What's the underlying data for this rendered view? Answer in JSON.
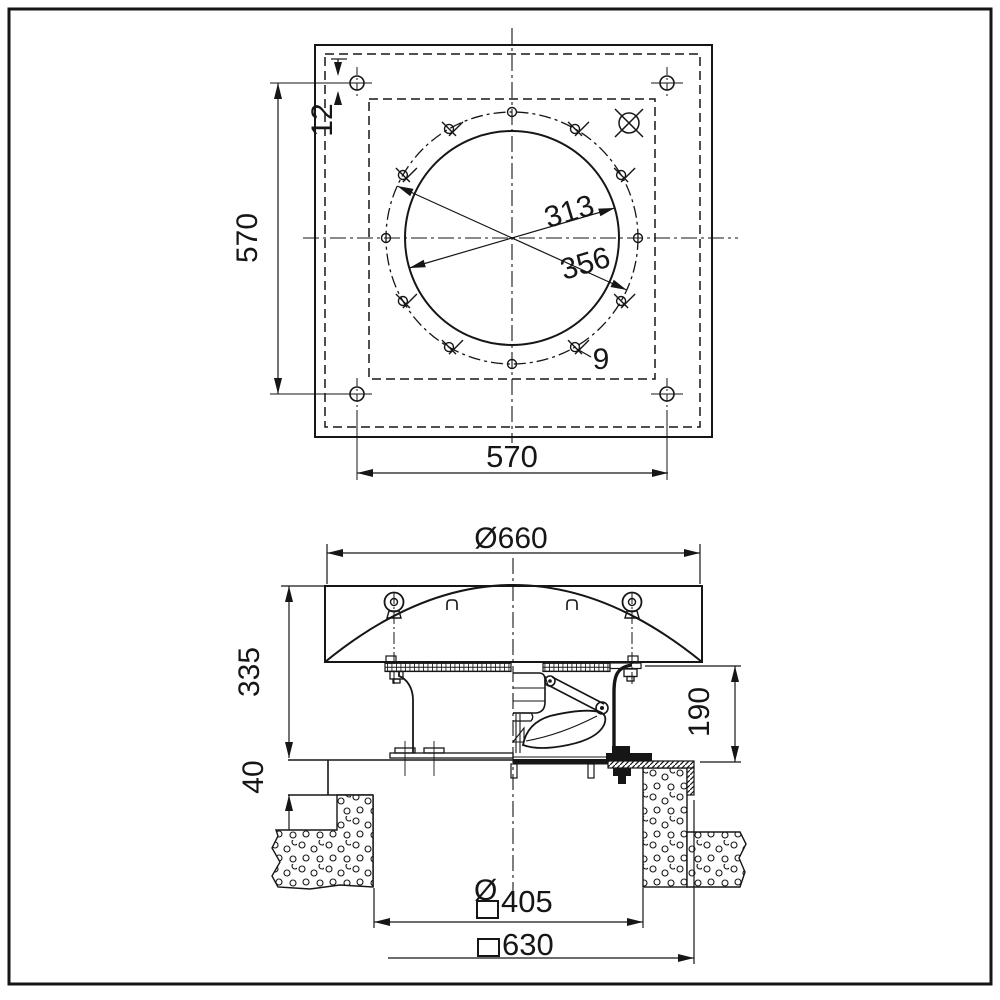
{
  "title": "roof-fan-dimension-drawing",
  "colors": {
    "line": "#161616",
    "background": "#ffffff"
  },
  "top_view": {
    "dim_hole": "12",
    "dim_vertical": "570",
    "dim_horizontal": "570",
    "dim_impeller": "313",
    "dim_bolt_circle": "356",
    "dim_hole_dia": "9"
  },
  "side_view": {
    "dim_hood": "Ø660",
    "dim_height_total": "335",
    "dim_height_body": "190",
    "dim_roof": "40",
    "sym_round": "Ø",
    "dim_opening": "405",
    "dim_base": "630"
  }
}
